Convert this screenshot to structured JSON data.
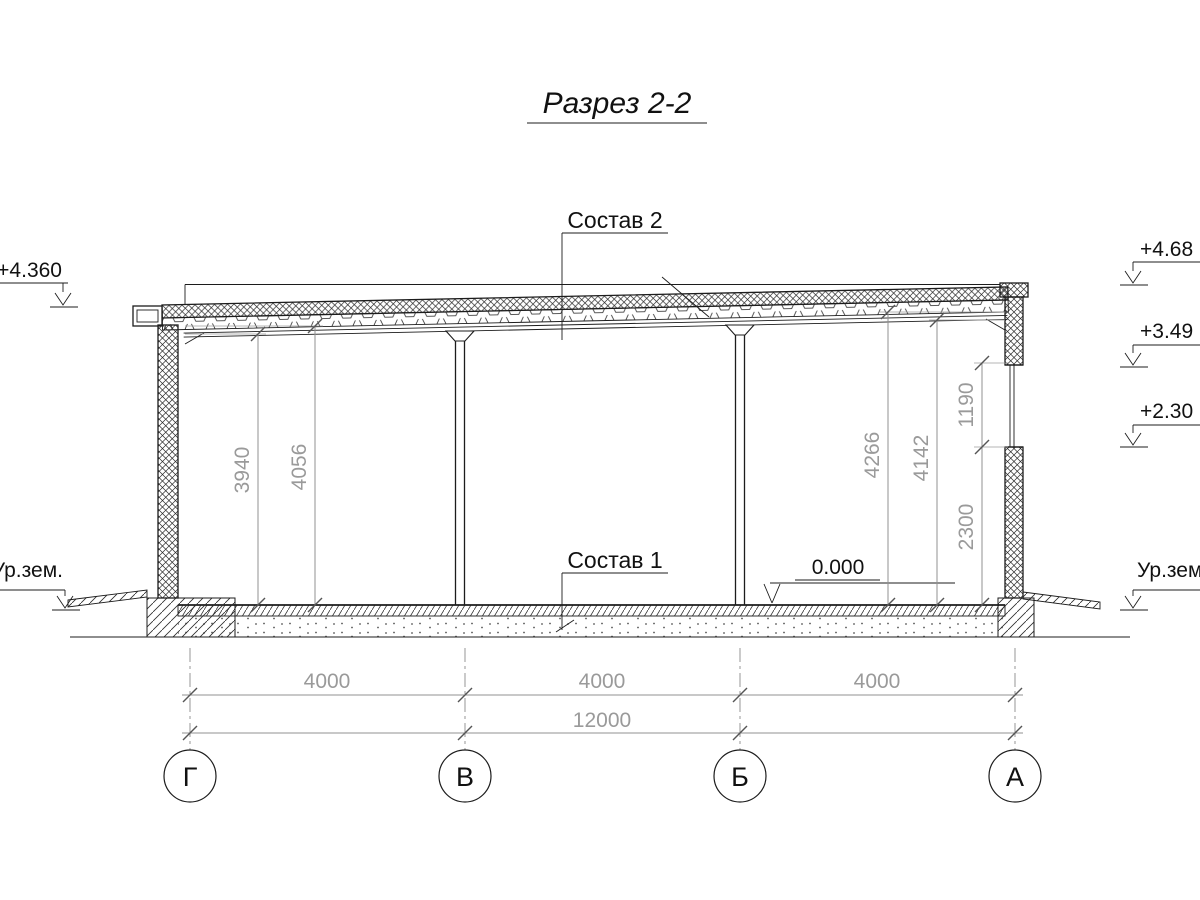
{
  "title": "Разрез 2-2",
  "callouts": {
    "roof": "Состав 2",
    "floor": "Состав 1"
  },
  "elevation_marks": {
    "left_top": "+4.360",
    "right_top": "+4.68",
    "right_mid": "+3.49",
    "right_low": "+2.30",
    "zero": "0.000",
    "ground_left": "Ур.зем.",
    "ground_right": "Ур.зем."
  },
  "vertical_dimensions": {
    "left": [
      "3940",
      "4056"
    ],
    "right": [
      "4266",
      "4142"
    ],
    "window": [
      "1190",
      "2300"
    ]
  },
  "horizontal_dimensions": {
    "spans": [
      "4000",
      "4000",
      "4000"
    ],
    "total": "12000"
  },
  "axes": [
    "Г",
    "В",
    "Б",
    "А"
  ],
  "colors": {
    "line": "#1c1c1c",
    "dim_line": "#909090",
    "dim_text": "#9a9a9a"
  }
}
